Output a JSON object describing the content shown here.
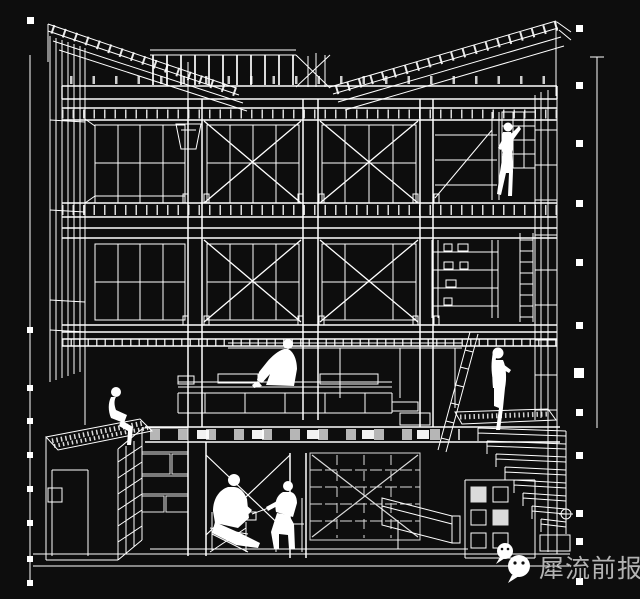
{
  "colors": {
    "background": "#0d0d0d",
    "line": "#ffffff",
    "watermark_text": "#b3b3b3",
    "watermark_logo": "#ffffff"
  },
  "watermark": {
    "text": "犀流前报",
    "icon": "wechat-logo"
  },
  "drawing": {
    "kind": "architectural-section-axonometric-wireframe"
  }
}
